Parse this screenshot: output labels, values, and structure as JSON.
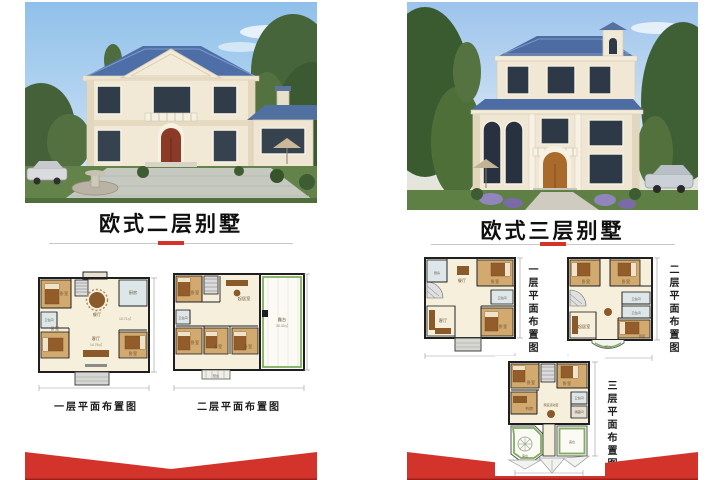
{
  "colors": {
    "accent_red": "#d2342c",
    "roof_blue": "#4d6ca3",
    "wall_cream": "#f0e7d5"
  },
  "left_panel": {
    "title": "欧式二层别墅",
    "floor1": {
      "caption": "一层平面布置图",
      "rooms": {
        "bedroom_tl": "卧室",
        "bedroom_bl": "卧室",
        "bedroom_br": "卧室",
        "living": "客厅",
        "dining": "餐厅",
        "kitchen": "厨房",
        "bath": "卫生间",
        "area_living": "14.76㎡",
        "area_hall": "10.71㎡"
      }
    },
    "floor2": {
      "caption": "二层平面布置图",
      "rooms": {
        "bedroom_tl": "卧室",
        "bedroom_bl": "卧室",
        "bedroom_bc": "卧室",
        "bedroom_br": "卧室",
        "sitting": "起居室",
        "bath": "卫生间",
        "terrace": "露台",
        "terrace_area": "30.33㎡",
        "balcony": "阳台"
      }
    }
  },
  "right_panel": {
    "title": "欧式三层别墅",
    "floor1": {
      "caption": "一层平面布置图",
      "rooms": {
        "kitchen": "厨房",
        "dining": "餐厅",
        "bedroom_tr": "卧室",
        "bedroom_br": "卧室",
        "living": "客厅",
        "bath": "卫生间"
      }
    },
    "floor2": {
      "caption": "二层平面布置图",
      "rooms": {
        "bedroom_tl": "卧室",
        "bedroom_tr": "卧室",
        "bedroom_br": "卧室",
        "sitting": "起居室",
        "bath1": "卫生间",
        "bath2": "卫生间",
        "balcony": "阳台"
      }
    },
    "floor3": {
      "caption": "三层平面布置图",
      "rooms": {
        "bedroom_tl": "卧室",
        "bedroom_tr": "卧室",
        "study": "书房",
        "family": "家庭活动室",
        "bath": "卫生间",
        "storage": "储藏间",
        "terrace_l": "露台",
        "terrace_r": "露台"
      }
    }
  }
}
